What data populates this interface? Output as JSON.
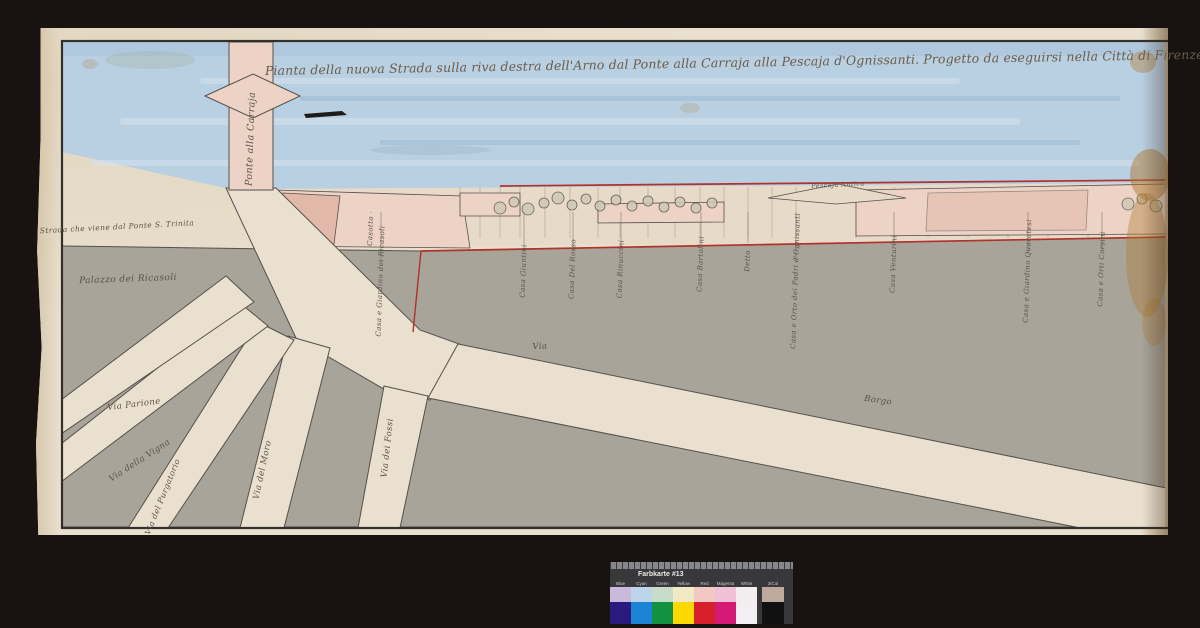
{
  "document": {
    "type": "scanned historical map with color calibration card",
    "title": "Pianta della nuova Strada sulla riva destra dell'Arno dal Ponte alla Carraja alla Pescaja d'Ognissanti.   Progetto da eseguirsi nella Città di Firenze &"
  },
  "colors": {
    "scan_bg": "#181310",
    "paper": "#e9e0cf",
    "ink": "#33302b",
    "river": "#b9cfe2",
    "river_streak": "#9cbbd6",
    "river_light": "#d5e3ee",
    "gray_block": "#a8a49a",
    "gray_stroke": "#55504a",
    "pink_light": "#ecd3c6",
    "pink": "#e2b8aa",
    "bank": "#e8dac9",
    "red_line": "#b03228",
    "label_ink": "#5c5248",
    "stain": "#b07a2f",
    "card_bg": "#38383a",
    "card_text": "#eaeaea"
  },
  "labels": [
    {
      "name": "map-title",
      "text": "Pianta della nuova Strada sulla riva destra dell'Arno dal Ponte alla Carraja alla Pescaja d'Ognissanti.   Progetto da eseguirsi nella Città di Firenze &",
      "x": 742,
      "y": 63,
      "rot": -1,
      "size": 12.5,
      "cls": "title"
    },
    {
      "name": "label-ponte-alla-carraja",
      "text": "Ponte alla Carraja",
      "x": 251,
      "y": 139,
      "rot": -88,
      "size": 9.5
    },
    {
      "name": "label-strada-ponte-s-trinita",
      "text": "Strada che viene dal Ponte S. Trinita",
      "x": 117,
      "y": 227,
      "rot": -3,
      "size": 7.5
    },
    {
      "name": "label-palazzo-ricasoli",
      "text": "Palazzo dei Ricasoli",
      "x": 128,
      "y": 280,
      "rot": -2,
      "size": 9
    },
    {
      "name": "label-via-parione",
      "text": "Via Parione",
      "x": 134,
      "y": 405,
      "rot": -7,
      "size": 8.5
    },
    {
      "name": "label-via-della-vigna",
      "text": "Via della Vigna",
      "x": 140,
      "y": 461,
      "rot": -33,
      "size": 8.5
    },
    {
      "name": "label-via-del-purgatorio",
      "text": "Via del Purgatorio",
      "x": 163,
      "y": 497,
      "rot": -68,
      "size": 8
    },
    {
      "name": "label-via-del-moro",
      "text": "Via del Moro",
      "x": 263,
      "y": 470,
      "rot": -78,
      "size": 8.5
    },
    {
      "name": "label-via-dei-fossi",
      "text": "Via dei Fossi",
      "x": 388,
      "y": 448,
      "rot": -84,
      "size": 8.5
    },
    {
      "name": "label-via",
      "text": "Via",
      "x": 540,
      "y": 347,
      "rot": -4,
      "size": 8.5
    },
    {
      "name": "label-borgo",
      "text": "Borgo",
      "x": 878,
      "y": 401,
      "rot": 8,
      "size": 8.5
    },
    {
      "name": "label-pescaja",
      "text": "Pescaja Antica",
      "x": 838,
      "y": 185,
      "rot": -3,
      "size": 6.5
    },
    {
      "name": "bank-property-label",
      "text": "Casotto",
      "x": 371,
      "y": 231,
      "rot": -88,
      "size": 7
    },
    {
      "name": "bank-property-label",
      "text": "Casa e Giardino dei Ricasoli",
      "x": 381,
      "y": 281,
      "rot": -88,
      "size": 7
    },
    {
      "name": "bank-property-label",
      "text": "Casa Giuntini",
      "x": 524,
      "y": 271,
      "rot": -88,
      "size": 7
    },
    {
      "name": "bank-property-label",
      "text": "Casa Del Rosso",
      "x": 573,
      "y": 269,
      "rot": -88,
      "size": 7
    },
    {
      "name": "bank-property-label",
      "text": "Casa Rinuccini",
      "x": 621,
      "y": 269,
      "rot": -88,
      "size": 7
    },
    {
      "name": "bank-property-label",
      "text": "Casa Bartolini",
      "x": 701,
      "y": 264,
      "rot": -88,
      "size": 7
    },
    {
      "name": "bank-property-label",
      "text": "Detto",
      "x": 748,
      "y": 261,
      "rot": -88,
      "size": 7
    },
    {
      "name": "bank-property-label",
      "text": "Casa e Orto dei Padri d'Ognissanti",
      "x": 796,
      "y": 281,
      "rot": -88,
      "size": 7
    },
    {
      "name": "bank-property-label",
      "text": "Casa Venturini",
      "x": 894,
      "y": 264,
      "rot": -88,
      "size": 7
    },
    {
      "name": "bank-property-label",
      "text": "Casa e Giardino Quaratesi",
      "x": 1028,
      "y": 271,
      "rot": -88,
      "size": 7
    },
    {
      "name": "bank-property-label",
      "text": "Casa e Orti Corsini",
      "x": 1102,
      "y": 269,
      "rot": -88,
      "size": 7
    }
  ],
  "color_card": {
    "title": "Farbkarte #13",
    "column_labels": [
      "Blue",
      "Cyan",
      "Green",
      "Yellow",
      "Red",
      "Magenta",
      "White",
      "3/Col"
    ],
    "top_row": [
      "#c9b9da",
      "#bdd5ec",
      "#c8dcca",
      "#f1e9c4",
      "#f2c8c4",
      "#efc0d6",
      "#f3edf0",
      "#bfa89e"
    ],
    "bottom_row": [
      "#2b1a7e",
      "#1b84d4",
      "#129140",
      "#fed900",
      "#d6202c",
      "#d41a74",
      "#f2eff2",
      "#111111"
    ]
  }
}
